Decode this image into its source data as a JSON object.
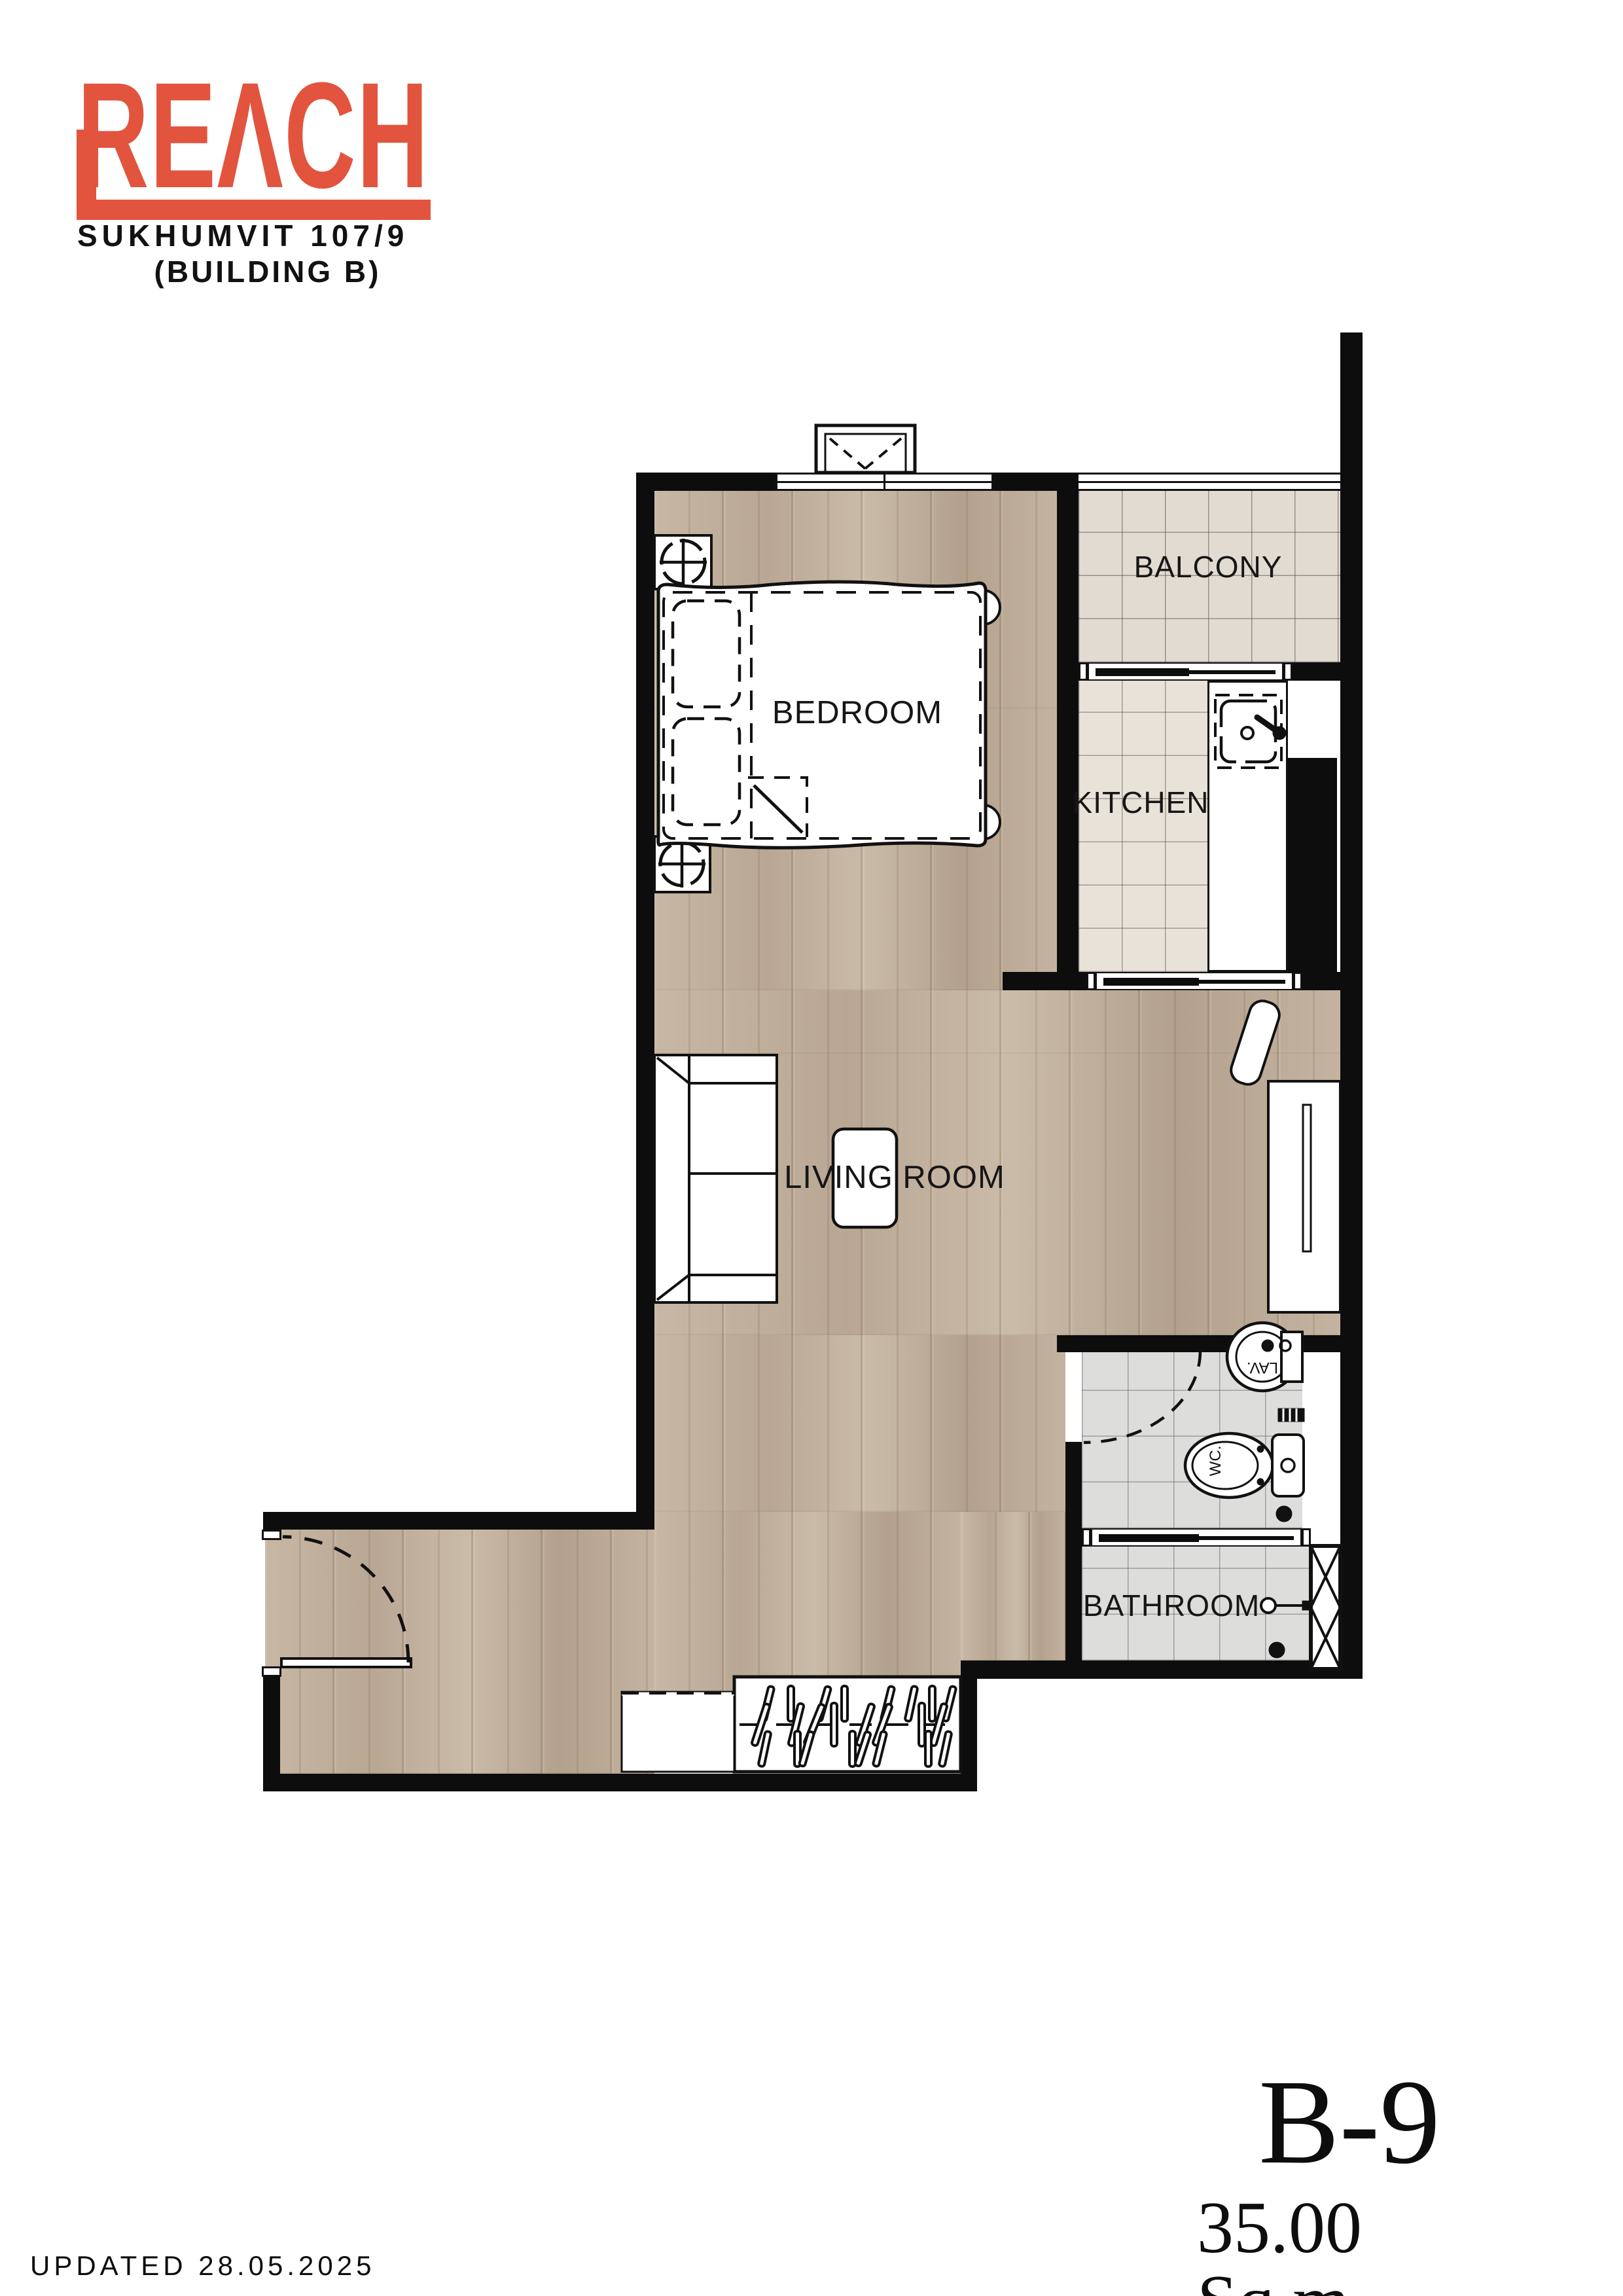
{
  "logo": {
    "brand": "REΛCH",
    "project": "SUKHUMVIT 107/9",
    "building": "(BUILDING B)"
  },
  "rooms": {
    "bedroom": "BEDROOM",
    "living": "LIVING ROOM",
    "kitchen": "KITCHEN",
    "balcony": "BALCONY",
    "bathroom": "BATHROOM"
  },
  "fixtures": {
    "toilet": "WC.",
    "basin": "LAV."
  },
  "unit": {
    "code": "B-9",
    "area": "35.00 Sq.m."
  },
  "meta": {
    "updated": "UPDATED 28.05.2025"
  },
  "colors": {
    "brand_red": "#E2543E",
    "wall_black": "#0d0d0d",
    "wood_floor": "#c0af9c",
    "balcony_tile": "#e2dbd1",
    "kitchen_tile": "#e9e2d8",
    "bathroom_tile": "#dddddb"
  }
}
